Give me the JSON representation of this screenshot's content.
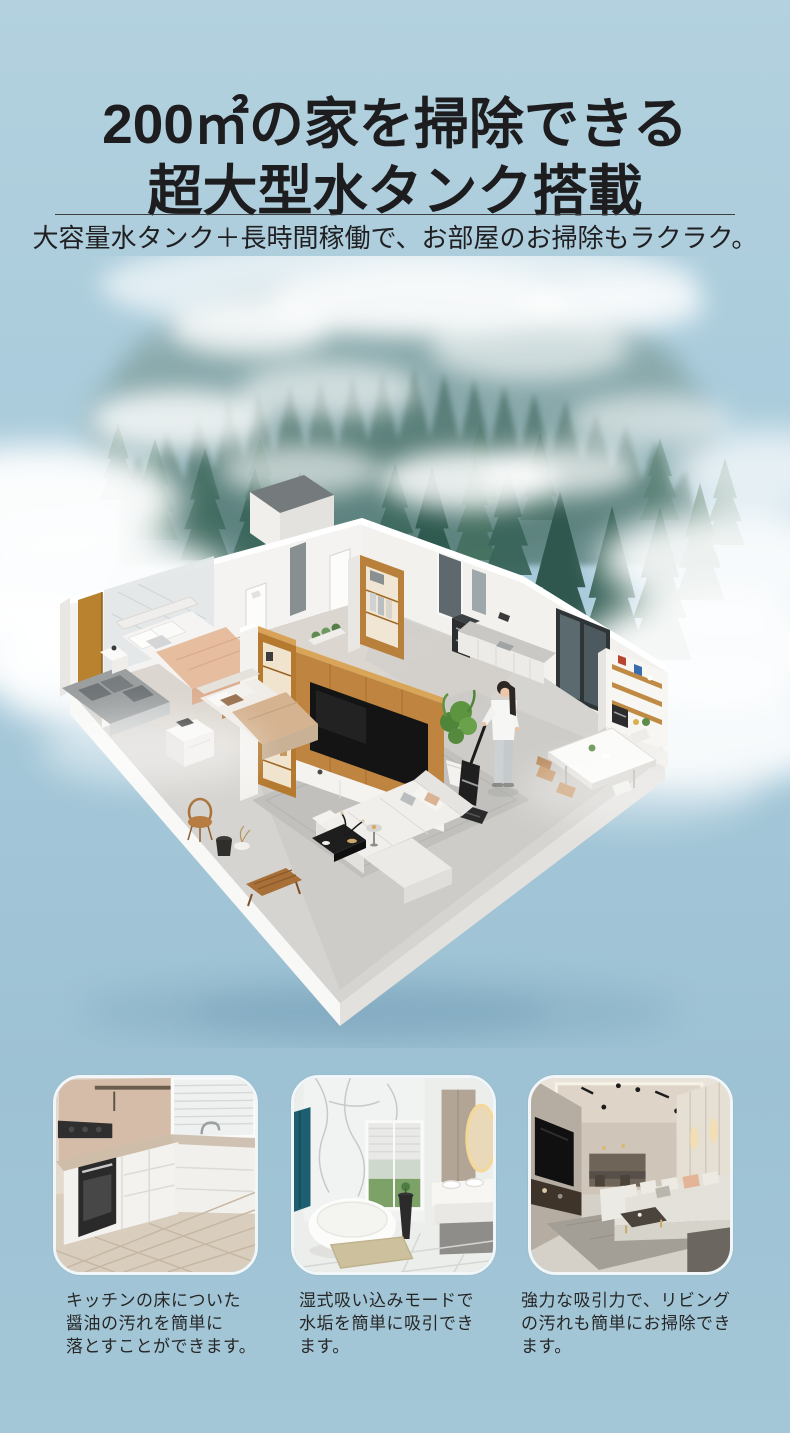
{
  "page": {
    "background_top": "#b3d1df",
    "background_bottom": "#9dc2d4",
    "title_color": "#1d1d1f"
  },
  "header": {
    "title_line1": "200㎡の家を掃除できる",
    "title_line2": "超大型水タンク搭載",
    "subtitle": "大容量水タンク＋長時間稼働で、お部屋のお掃除もラクラク。"
  },
  "hero": {
    "scene": "isometric-apartment-cutaway-floor-plan",
    "background": "misty-pine-forest-with-clouds",
    "figure": "woman-using-cordless-wet-dry-vacuum"
  },
  "features": [
    {
      "id": "kitchen",
      "caption": "キッチンの床についた\n醤油の汚れを簡単に\n落とすことができます。"
    },
    {
      "id": "bathroom",
      "caption": "湿式吸い込みモードで\n水垢を簡単に吸引でき\nます。"
    },
    {
      "id": "living-room",
      "caption": "強力な吸引力で、リビング\nの汚れも簡単にお掃除でき\nます。"
    }
  ]
}
